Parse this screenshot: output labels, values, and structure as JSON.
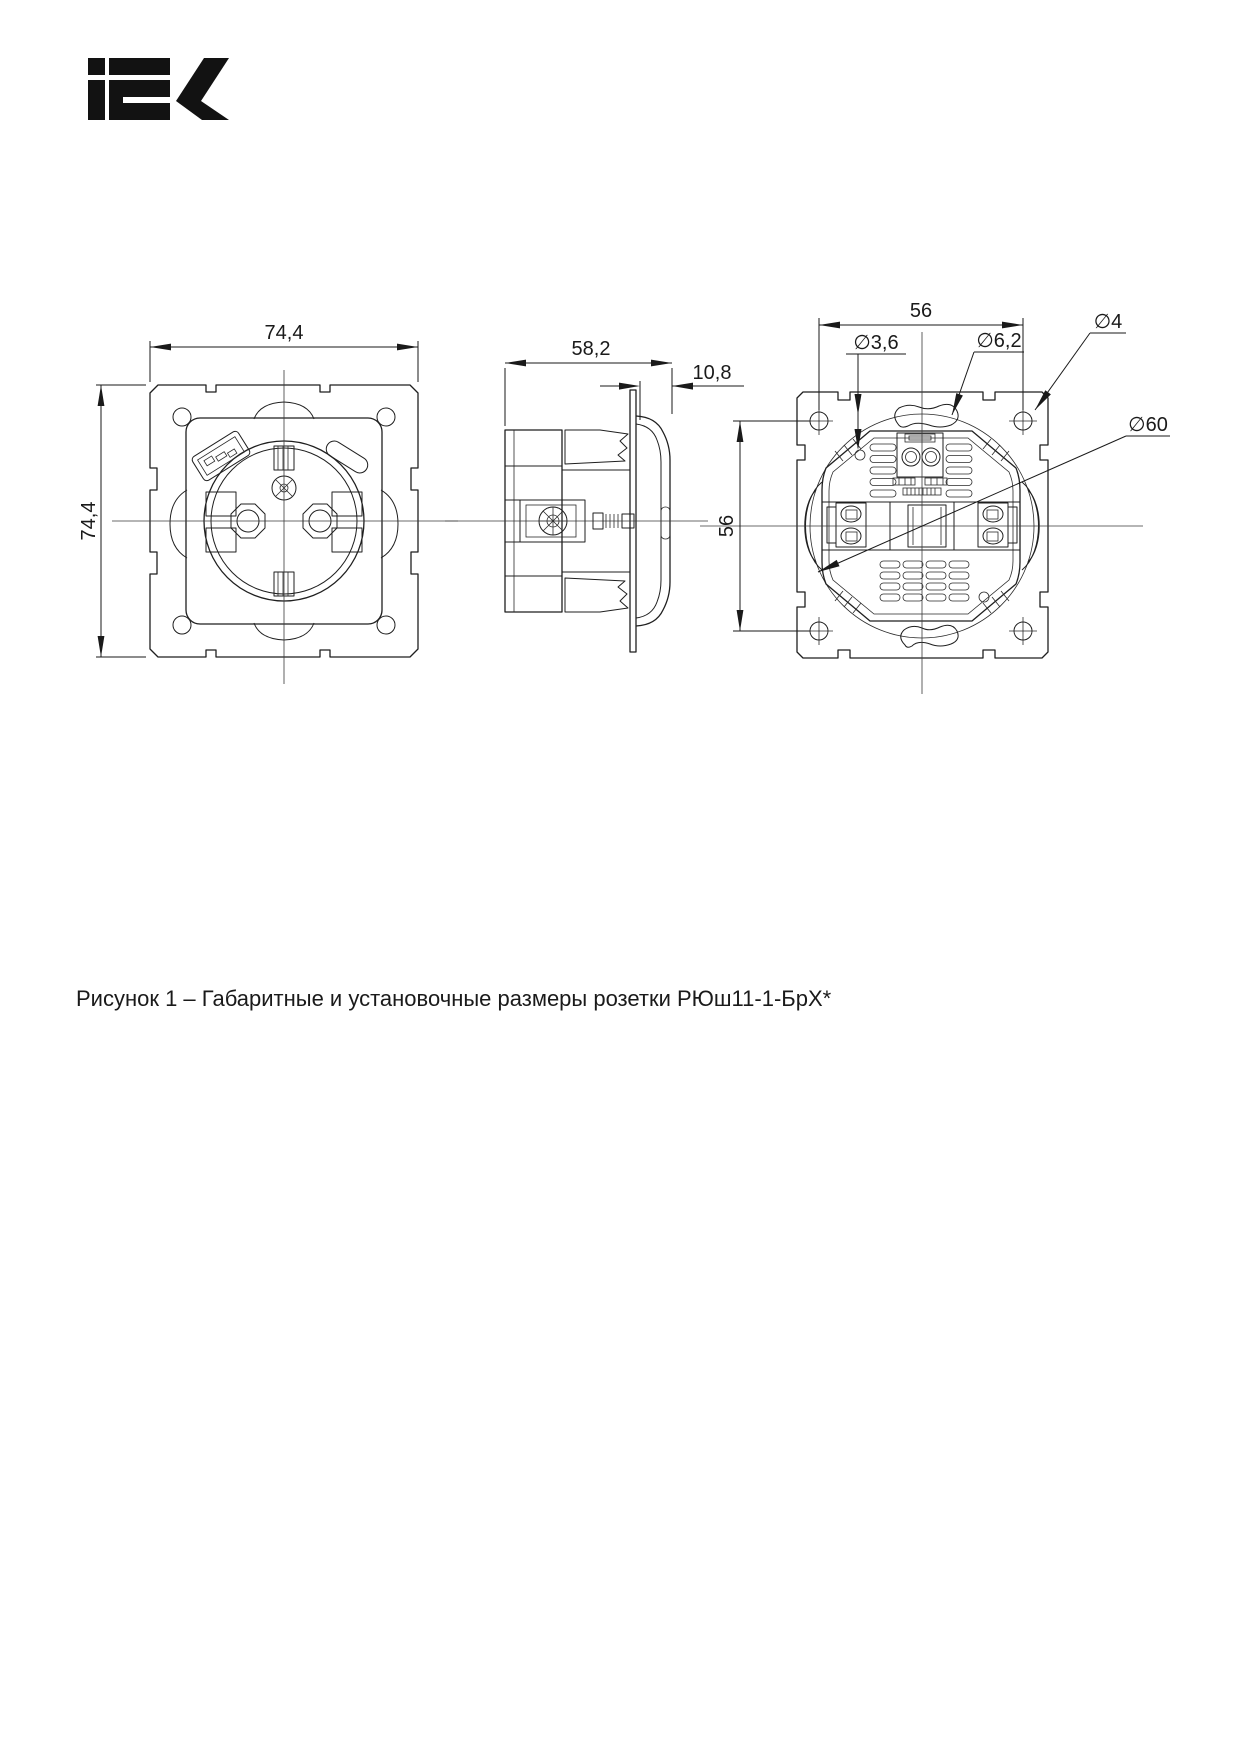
{
  "brand": {
    "name": "IEK"
  },
  "views": {
    "front": {
      "dim_width": "74,4",
      "dim_height": "74,4"
    },
    "side": {
      "dim_depth": "58,2",
      "dim_frame": "10,8"
    },
    "back": {
      "dim_h": "56",
      "dim_v": "56",
      "dia_claw_screw": "∅3,6",
      "dia_slot": "∅6,2",
      "dia_corner_hole": "∅4",
      "dia_body": "∅60"
    }
  },
  "caption": {
    "text": "Рисунок 1 – Габаритные и установочные размеры розетки РЮш11-1-БрХ*"
  }
}
